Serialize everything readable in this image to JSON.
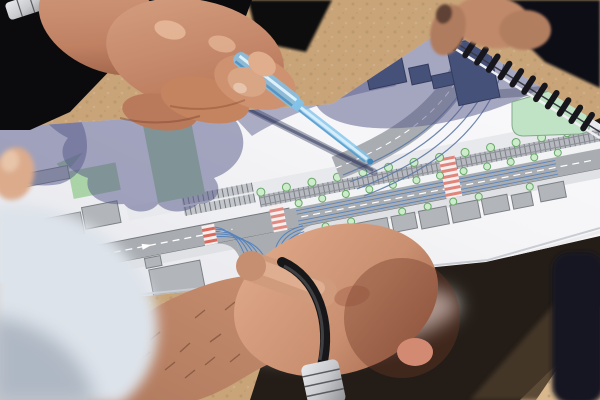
{
  "scene": {
    "type": "photograph",
    "subject": "Two people examining a spiral-bound street redesign plan held outdoors; one hand points with a translucent blue pen at the tram corridor while a foreground fist with a black bracelet rests on the page",
    "setting": "bright sunlight over sandy ground with hard cast shadows"
  },
  "objects": {
    "booklet": "spiral-bound traffic plan booklet",
    "drawing": "streetscape plan: avenue with tram tracks, tree rows, crosswalks, turning guide lines, buildings and green spaces",
    "pen": "translucent blue pen",
    "accessories": [
      "silver-wristwatch",
      "black-rubber-bracelet",
      "metal-watch-band"
    ]
  },
  "map_features": {
    "roads": [
      "main-avenue-with-tram-corridor",
      "side-street-t-junction",
      "curved-link-road"
    ],
    "markings": [
      "dashed-centerline",
      "blue-turn-guide-lines",
      "red-and-pink-crosswalks",
      "parking-stalls",
      "tram-sleeper-ticks"
    ],
    "landscape": [
      "street-tree-rows",
      "green-squares",
      "triangular-traffic-island"
    ],
    "buildings": "grey building footprints along both sides of the avenue"
  },
  "colors": {
    "sand": "#c8a478",
    "sandLight": "#d8b88c",
    "groundShadow": "#241d17",
    "groundShadow2": "#4a3b2c",
    "navyObject": "#131824",
    "paper": "#f5f5f7",
    "paperDim": "#e4e5eb",
    "shadow": "rgba(88,90,138,0.52)",
    "roadGray": "#a9adb2",
    "roadMid": "#c3c6ca",
    "roadEdge": "#74787d",
    "sidewalk": "#e8e9ec",
    "buildingFill": "#b2b6ba",
    "buildingStroke": "#7c8085",
    "buildingDark": "#46517a",
    "buildingDarkStroke": "#333c5e",
    "green": "#abd3a8",
    "greenLight": "#bfe3c4",
    "treeFill": "#cdeccb",
    "treeStroke": "#69a869",
    "laneBlue": "#4d7fc0",
    "curveBlue": "#5d79a8",
    "crosswalkRed": "#d96a5e",
    "crosswalkBase": "#f6efee",
    "penBlue": "#7fc3ec",
    "penCore": "#dcf1fb",
    "penEdge": "#3e86bb",
    "skinLight": "#e2ac8c",
    "skin": "#c98f70",
    "skinShadow": "#a06048",
    "sleeve": "#0b0b0e",
    "torso": "#0c0d13",
    "watchSilver": "#c9cacd",
    "watchDark": "#595b60",
    "bracelet": "#17171a",
    "fabric": "#dde3ea",
    "fabricDim": "#aab3c0",
    "binding": "#16161c",
    "pageEdge": "#c9cdd3"
  }
}
